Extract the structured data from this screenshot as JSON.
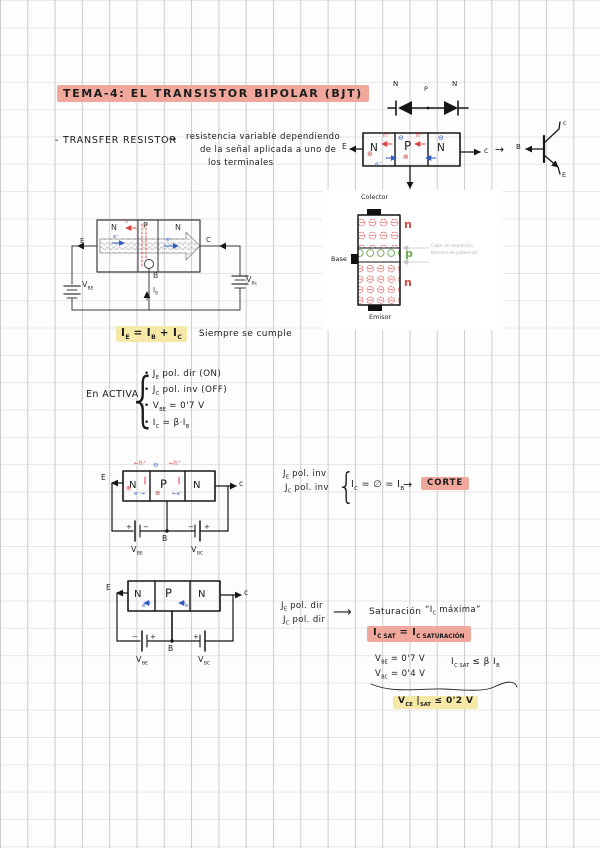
{
  "page": {
    "title": "TEMA-4: EL TRANSISTOR BIPOLAR (BJT)"
  },
  "colors": {
    "pink": "#f0a79c",
    "yellow": "#f6e9a8",
    "red": "#d64545",
    "blue": "#2f5bc4",
    "green": "#6aa84f"
  },
  "sym": {
    "arrow": "→",
    "long_arrow": "⟶",
    "brace": "{",
    "hplus_left": "←h⁺",
    "hplus": "h⁺",
    "eminus": "e⁻",
    "eminus_right": "e⁻→",
    "eminus_left": "←e⁻",
    "oplus": "⊕",
    "ominus": "⊖",
    "plus": "+",
    "minus": "−"
  },
  "intro": {
    "bullet": "- TRANSFER RESISTOR",
    "l1": "resistencia variable dependiendo",
    "l2": "de la señal aplicada a uno de",
    "l3": "los terminales"
  },
  "regions": {
    "n": "N",
    "p": "P"
  },
  "regions_img": {
    "n": "n",
    "p": "p"
  },
  "terminals": {
    "e": "E",
    "c": "C",
    "b": "B",
    "c_small": "c"
  },
  "vertical_npn": {
    "collector": "Colector",
    "base": "Base",
    "emitter": "Emisor",
    "cap1": "Capa de depleción",
    "cap2": "Barrera de potencial"
  },
  "labels": {
    "vbe": [
      [
        "V",
        0
      ],
      [
        "BE",
        1
      ]
    ],
    "vbc": [
      [
        "V",
        0
      ],
      [
        "BC",
        1
      ]
    ],
    "vbc_alt": [
      [
        "V",
        0
      ],
      [
        "Bc",
        1
      ]
    ],
    "ib": [
      [
        "I",
        0
      ],
      [
        "B",
        1
      ]
    ]
  },
  "kirchhoff": {
    "eq": [
      [
        "I",
        0
      ],
      [
        "E",
        1
      ],
      [
        " = I",
        0
      ],
      [
        "B",
        1
      ],
      [
        " + I",
        0
      ],
      [
        "C",
        1
      ]
    ],
    "note": "Siempre se cumple"
  },
  "active": {
    "label": "En ACTIVA",
    "i1": [
      [
        "• J",
        0
      ],
      [
        "E",
        1
      ],
      [
        "  pol. dir (ON)",
        0
      ]
    ],
    "i2": [
      [
        "• J",
        0
      ],
      [
        "C",
        1
      ],
      [
        "  pol. inv (OFF)",
        0
      ]
    ],
    "i3": [
      [
        "• V",
        0
      ],
      [
        "BE",
        1
      ],
      [
        " = 0'7 V",
        0
      ]
    ],
    "i4": [
      [
        "• I",
        0
      ],
      [
        "C",
        1
      ],
      [
        " = β·I",
        0
      ],
      [
        "B",
        1
      ]
    ]
  },
  "corte": {
    "j1": [
      [
        "J",
        0
      ],
      [
        "E",
        1
      ],
      [
        "   pol. inv",
        0
      ]
    ],
    "j2": [
      [
        "J",
        0
      ],
      [
        "C",
        1
      ],
      [
        "   pol. inv",
        0
      ]
    ],
    "eq": [
      [
        "I",
        0
      ],
      [
        "C",
        1
      ],
      [
        " = ∅ = I",
        0
      ],
      [
        "B",
        1
      ]
    ],
    "label": "CORTE"
  },
  "sat": {
    "j1": [
      [
        "J",
        0
      ],
      [
        "E",
        1
      ],
      [
        "   pol. dir",
        0
      ]
    ],
    "j2": [
      [
        "J",
        0
      ],
      [
        "C",
        1
      ],
      [
        "   pol. dir",
        0
      ]
    ],
    "title": "Saturación",
    "quote": [
      [
        "“I",
        0
      ],
      [
        "C",
        1
      ],
      [
        " máxima”",
        0
      ]
    ],
    "eq_main": [
      [
        "I",
        0
      ],
      [
        "C SAT",
        1
      ],
      [
        " = I",
        0
      ],
      [
        "C SATURACIÓN",
        1
      ]
    ],
    "vbe": [
      [
        "V",
        0
      ],
      [
        "BE",
        1
      ],
      [
        " = 0'7 V",
        0
      ]
    ],
    "vbc": [
      [
        "V",
        0
      ],
      [
        "BC",
        1
      ],
      [
        " = 0'4 V",
        0
      ]
    ],
    "ic_lim": [
      [
        "I",
        0
      ],
      [
        "C SAT",
        1
      ],
      [
        "  ≤  β I",
        0
      ],
      [
        "B",
        1
      ]
    ],
    "vce": [
      [
        "V",
        0
      ],
      [
        "CE",
        1
      ],
      [
        " |",
        0
      ],
      [
        "SAT",
        1
      ],
      [
        "  ≤ 0'2 V",
        0
      ]
    ]
  }
}
